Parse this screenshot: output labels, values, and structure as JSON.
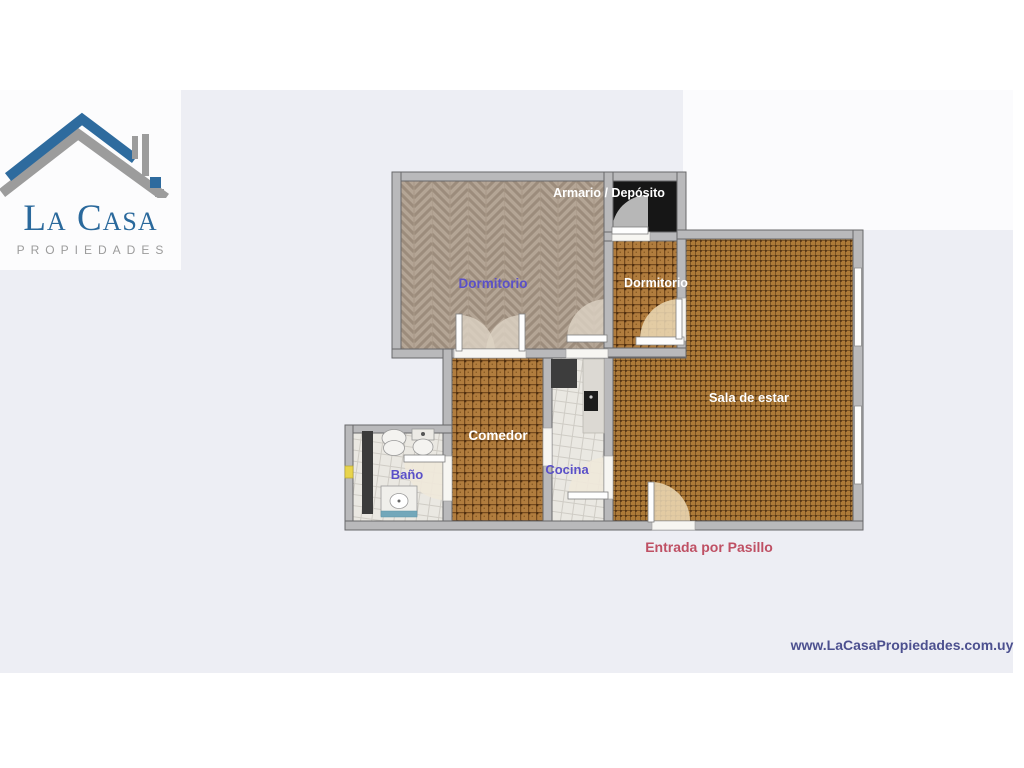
{
  "logo": {
    "title": "La Casa",
    "subtitle": "PROPIEDADES",
    "roof_blue": "#2e6b9e",
    "roof_gray": "#9c9c9c"
  },
  "floorplan": {
    "rooms": [
      {
        "id": "dormitorio-1",
        "label": "Dormitorio",
        "floor": "herringbone-wood"
      },
      {
        "id": "armario-deposito",
        "label": "Armario / Depósito",
        "floor": "dark"
      },
      {
        "id": "dormitorio-2",
        "label": "Dormitorio",
        "floor": "brown-tile"
      },
      {
        "id": "sala-de-estar",
        "label": "Sala de estar",
        "floor": "brown-tile"
      },
      {
        "id": "comedor",
        "label": "Comedor",
        "floor": "brown-tile"
      },
      {
        "id": "cocina",
        "label": "Cocina",
        "floor": "white-tile"
      },
      {
        "id": "bano",
        "label": "Baño",
        "floor": "white-tile"
      }
    ],
    "entrance_note": "Entrada por Pasillo",
    "colors": {
      "label_purple": "#5a50c8",
      "label_white": "#ffffff",
      "entrance_red": "#bf5064",
      "wall_gray": "#b9b9bb",
      "background": "#edeef4"
    }
  },
  "footer": {
    "website": "www.LaCasaPropiedades.com.uy",
    "website_color": "#4c508f"
  }
}
